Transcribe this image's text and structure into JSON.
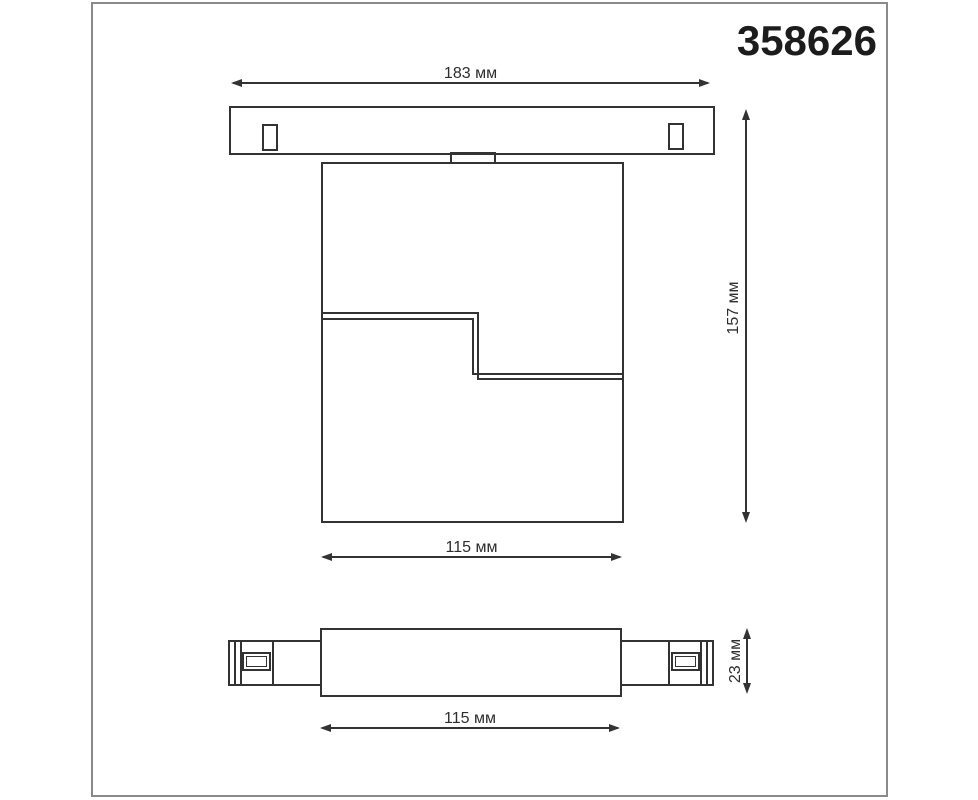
{
  "product_code": "358626",
  "units": "мм",
  "colors": {
    "line": "#333333",
    "text": "#2e2e2e",
    "frame_border": "#8a8a8a",
    "canvas_bg": "#ffffff",
    "code_text": "#1c1c1c"
  },
  "dimensions_mm": {
    "track_width": 183,
    "overall_height": 157,
    "body_width": 115,
    "body_height": 23
  },
  "front_view": {
    "track_width_label": "183 мм",
    "overall_height_label": "157 мм",
    "body_width_label": "115 мм"
  },
  "side_view": {
    "body_length_label": "115 мм",
    "body_height_label": "23 мм"
  }
}
